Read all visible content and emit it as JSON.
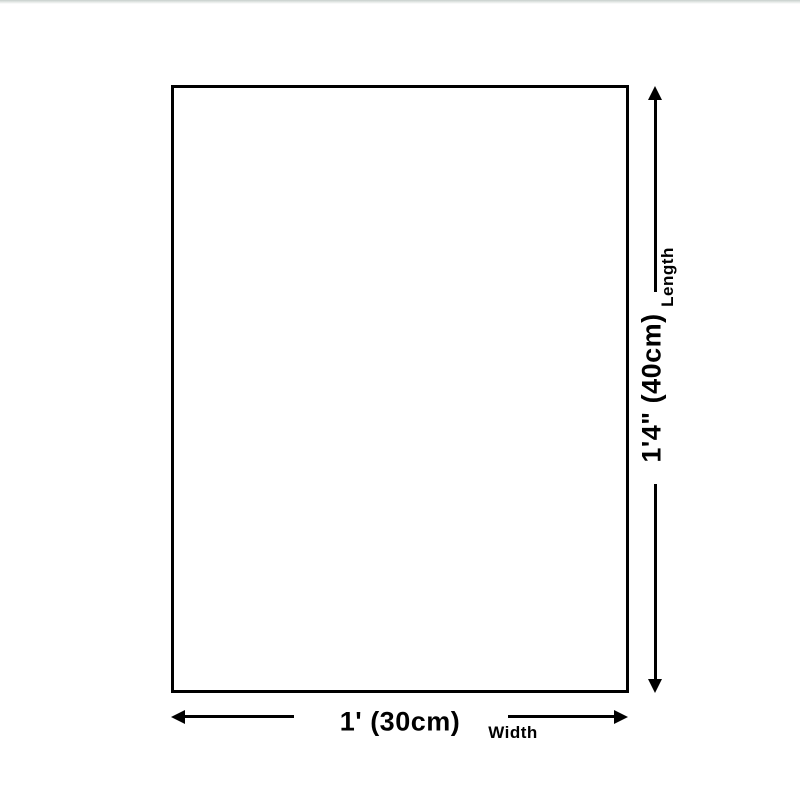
{
  "page": {
    "background_color": "#ffffff",
    "line_color": "#000000",
    "top_strip_color": "#c7cecb"
  },
  "dimensions": {
    "width": {
      "value": "1' (30cm)",
      "label": "Width"
    },
    "length": {
      "value": "1'4\" (40cm)",
      "label": "Length"
    }
  }
}
